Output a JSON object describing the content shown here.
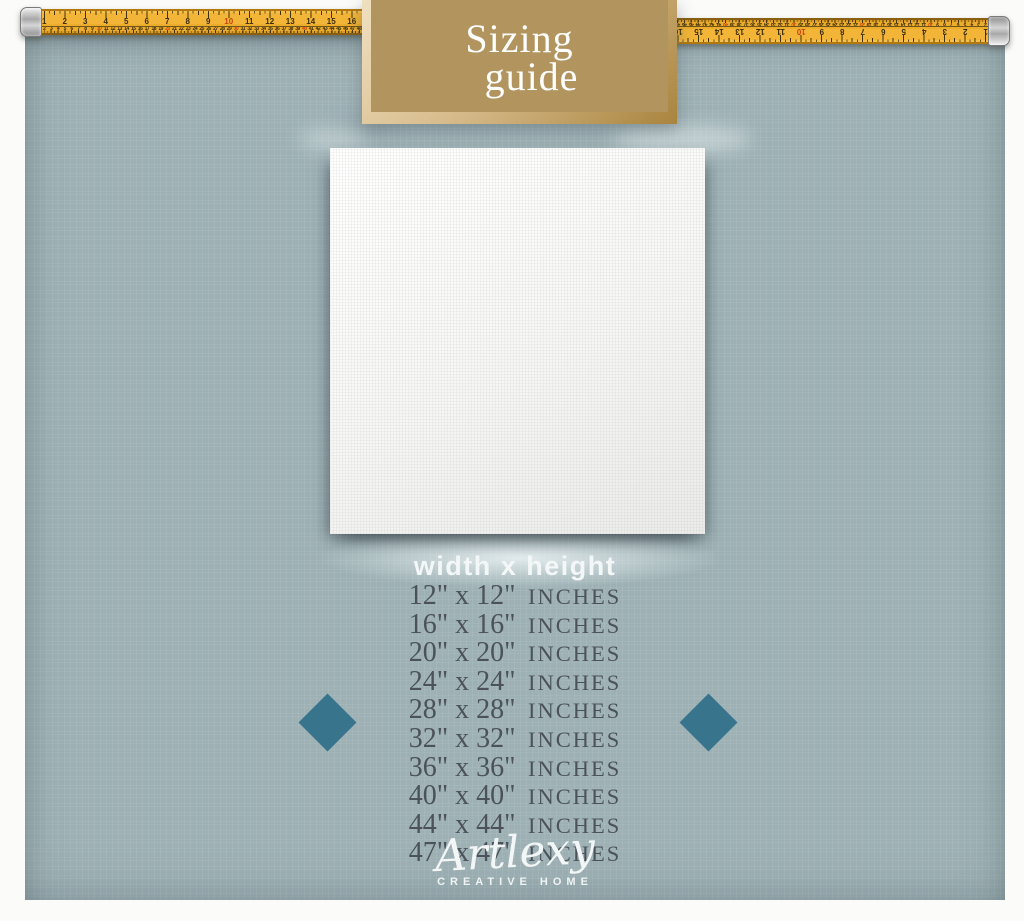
{
  "banner": {
    "title_line1": "Sizing",
    "title_line2": "guide"
  },
  "size_guide": {
    "header": "width x height",
    "rows": [
      {
        "dimensions": "12\" x 12\"",
        "unit": "INCHES"
      },
      {
        "dimensions": "16\" x 16\"",
        "unit": "INCHES"
      },
      {
        "dimensions": "20\" x 20\"",
        "unit": "INCHES"
      },
      {
        "dimensions": "24\" x 24\"",
        "unit": "INCHES"
      },
      {
        "dimensions": "28\" x 28\"",
        "unit": "INCHES"
      },
      {
        "dimensions": "32\" x 32\"",
        "unit": "INCHES"
      },
      {
        "dimensions": "36\" x 36\"",
        "unit": "INCHES"
      },
      {
        "dimensions": "40\" x 40\"",
        "unit": "INCHES"
      },
      {
        "dimensions": "44\" x 44\"",
        "unit": "INCHES"
      },
      {
        "dimensions": "47\" x 47\"",
        "unit": "INCHES"
      }
    ]
  },
  "brand": {
    "logo_text": "Artlexy",
    "tagline": "CREATIVE HOME"
  },
  "ruler": {
    "inch_numbers": [
      "1",
      "2",
      "3",
      "4",
      "5",
      "6",
      "7",
      "8",
      "9",
      "10",
      "11",
      "12",
      "13",
      "14",
      "15",
      "16",
      "17",
      "18",
      "19",
      "20"
    ],
    "cm_count": 66
  },
  "colors": {
    "panel_background": "#9db1b5",
    "banner_background": "#b2945f",
    "banner_border_light": "#f0e0c0",
    "banner_border_dark": "#a9843e",
    "diamond": "#38748c",
    "tape_yellow": "#f2b537",
    "size_text": "#4b525a",
    "canvas_white": "#fafaf8"
  }
}
